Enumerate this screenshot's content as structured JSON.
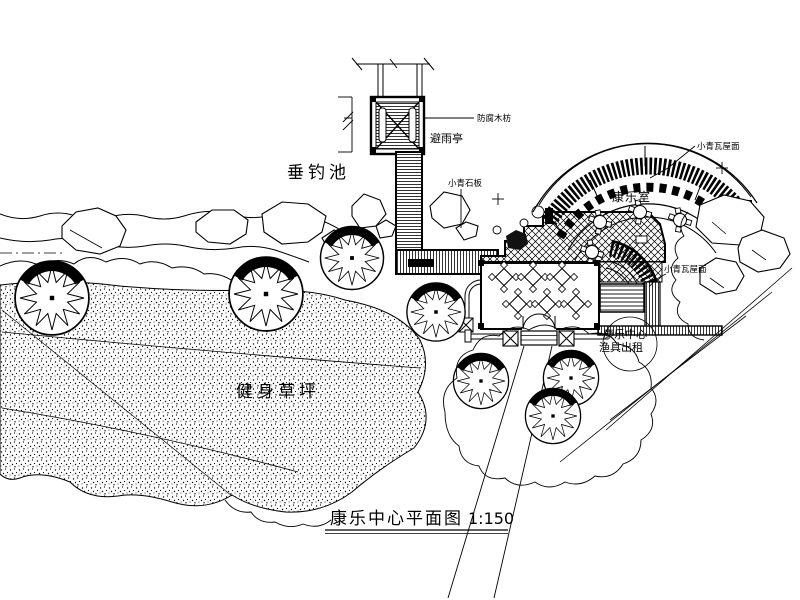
{
  "drawing": {
    "title": "康乐中心平面图",
    "scale": "1:150",
    "labels": {
      "pond": "垂钓池",
      "lawn": "健身草坪",
      "pavilion": "避雨亭",
      "pavilion_note": "防腐木枋",
      "paving_note": "小青石板",
      "hall": "康乐室",
      "roof_note_upper": "小青瓦屋面",
      "roof_note_lower": "小青瓦屋面",
      "center_line1": "康乐中心",
      "center_line2": "渔具出租"
    },
    "colors": {
      "ink": "#000000",
      "paper": "#ffffff"
    }
  }
}
